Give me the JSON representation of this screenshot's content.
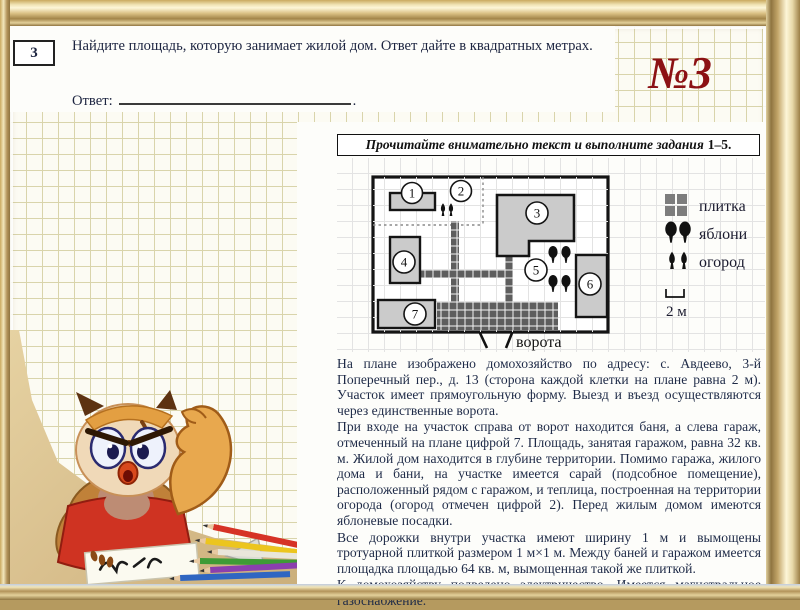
{
  "page": {
    "badge": "№3"
  },
  "task": {
    "number": "3",
    "text": "Найдите площадь, которую занимает жилой дом. Ответ дайте в квадратных метрах.",
    "answer_label": "Ответ:",
    "answer_suffix": "."
  },
  "instruction": {
    "italic": "Прочитайте внимательно текст и выполните задания",
    "range": "1–5."
  },
  "plan": {
    "labels": [
      "1",
      "2",
      "3",
      "4",
      "5",
      "6",
      "7"
    ],
    "gate_label": "ворота",
    "scale_label": "2 м",
    "legend": [
      {
        "icon": "tile-icon",
        "label": "плитка"
      },
      {
        "icon": "apple-trees-icon",
        "label": "яблони"
      },
      {
        "icon": "garden-icon",
        "label": "огород"
      }
    ]
  },
  "paragraphs": [
    "На плане изображено домохозяйство по адресу: с. Авдеево, 3-й Поперечный пер., д. 13 (сторона каждой клетки на плане равна 2 м). Участок имеет прямоугольную форму. Выезд и въезд осуществляются через единственные ворота.",
    "При входе на участок справа от ворот находится баня, а слева гараж, отмеченный на плане цифрой 7. Площадь, занятая гаражом, равна 32 кв. м. Жилой дом находится в глубине территории. Помимо гаража, жилого дома и бани, на участке имеется сарай (подсобное помещение), расположенный рядом с гаражом, и теплица, построенная на территории огорода (огород отмечен цифрой 2). Перед жилым домом имеются яблоневые посадки.",
    "Все дорожки внутри участка имеют ширину 1 м и вымощены тротуарной плиткой размером 1 м×1 м. Между баней и гаражом имеется площадка площадью 64 кв. м, вымощенная такой же плиткой.",
    "К домохозяйству подведено электричество. Имеется магистральное газоснабжение."
  ],
  "colors": {
    "badge_maroon": "#8c1114",
    "text_navy": "#1e2a47",
    "frame_gold": "#c4a76a",
    "grid_olive": "#d9d4ab",
    "plan_grid": "#e3e3e3",
    "building_gray": "#cbcbcb",
    "tile_dark": "#5e5e5e",
    "sand_tan": "#d7bd8b",
    "owl_shirt_red": "#cf3322"
  }
}
